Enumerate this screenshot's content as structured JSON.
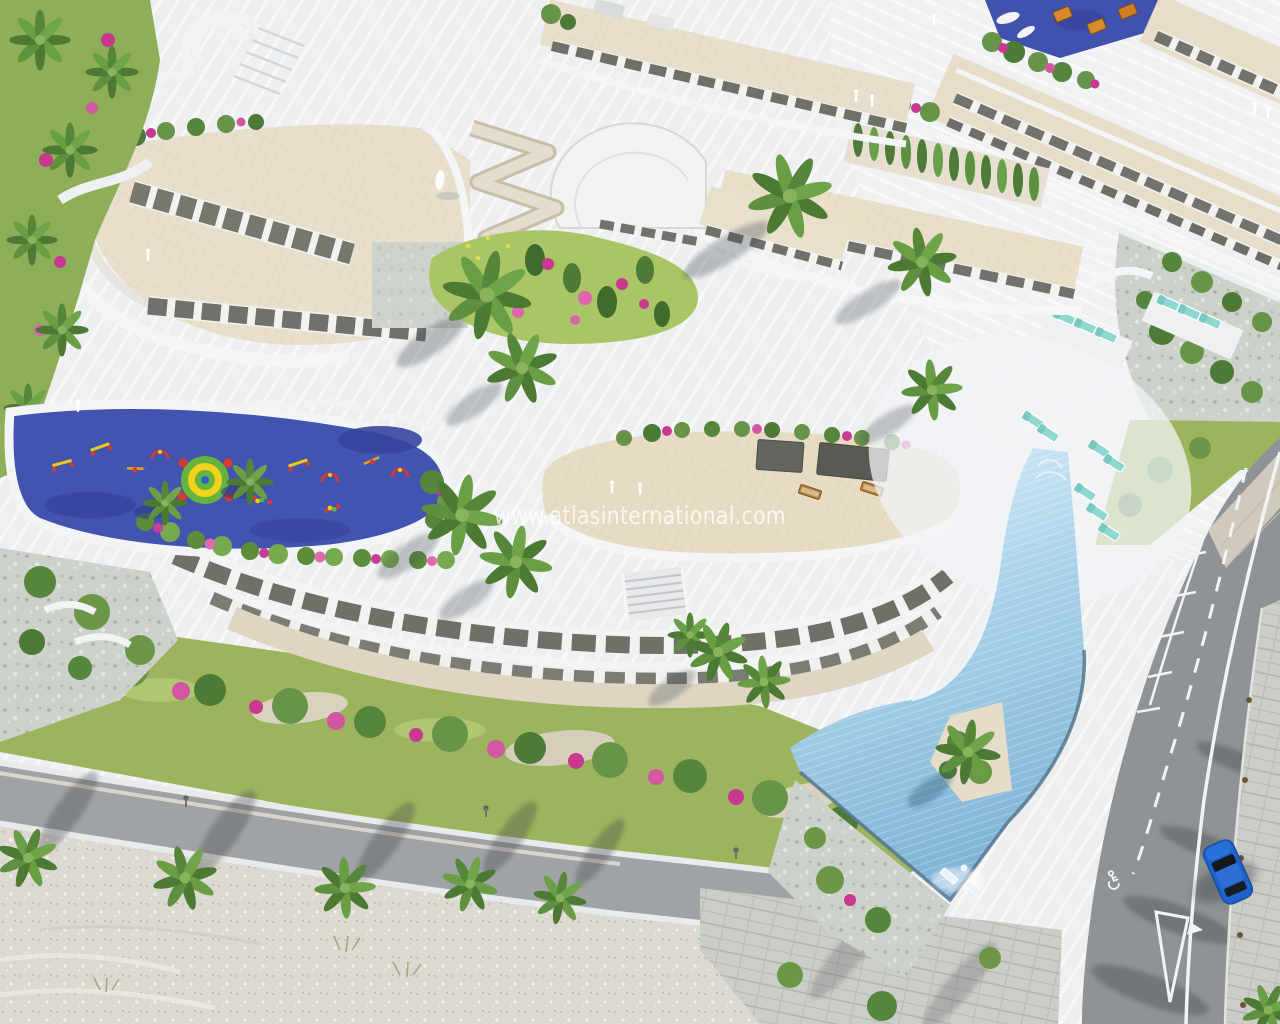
{
  "watermark": {
    "text": "www.atlasinternational.com"
  },
  "scene": {
    "type": "aerial-architectural-render",
    "setting": "bird's-eye view of a terraced seafront apartment resort on a hillside",
    "features": [
      "curved white terraced apartment buildings with cream roofs",
      "rooftop children's playground with blue safety surface and colourful play equipment",
      "long infinity swimming pool with angled lower basin and in-pool loungers",
      "rows of turquoise sun loungers on stepped sun decks",
      "gardens with palm trees and magenta bougainvillea",
      "zigzag switchback path down the slope",
      "coastal road with parking bays, disabled bay and give-way markings",
      "paved sidewalk with street palms",
      "one parked blue car",
      "palm-lined beach promenade",
      "sandy beach"
    ]
  },
  "road": {
    "markings": [
      "dashed centre line",
      "solid edge line",
      "parking bay ticks",
      "disabled-parking wheelchair symbol",
      "give-way triangle",
      "light paved crossing band"
    ]
  },
  "vehicles": {
    "visible_cars": 1,
    "car_color": "#1f62cf"
  },
  "palette": {
    "paving_white": "#edeff1",
    "stripe_white": "#ffffff",
    "roof_cream": "#e9dfcd",
    "terrace_beige": "#e8dcc5",
    "glass_dark": "#6e7168",
    "playground_blue": "#4353b0",
    "playground_green": "#67b33e",
    "playground_yellow": "#f2d41f",
    "equipment_red": "#d93a2a",
    "pool_light": "#d8ecf7",
    "pool_deep": "#7fb4d6",
    "lounger_turquoise": "#8ed8d1",
    "vegetation_green": "#6d9748",
    "bougainvillea_pink": "#c8398f",
    "road_asphalt": "#8f9296",
    "promenade_asphalt": "#9fa3a6",
    "beach_sand": "#dcd9d2",
    "car_blue": "#1f62cf",
    "marking_white": "#f2f3f4"
  }
}
